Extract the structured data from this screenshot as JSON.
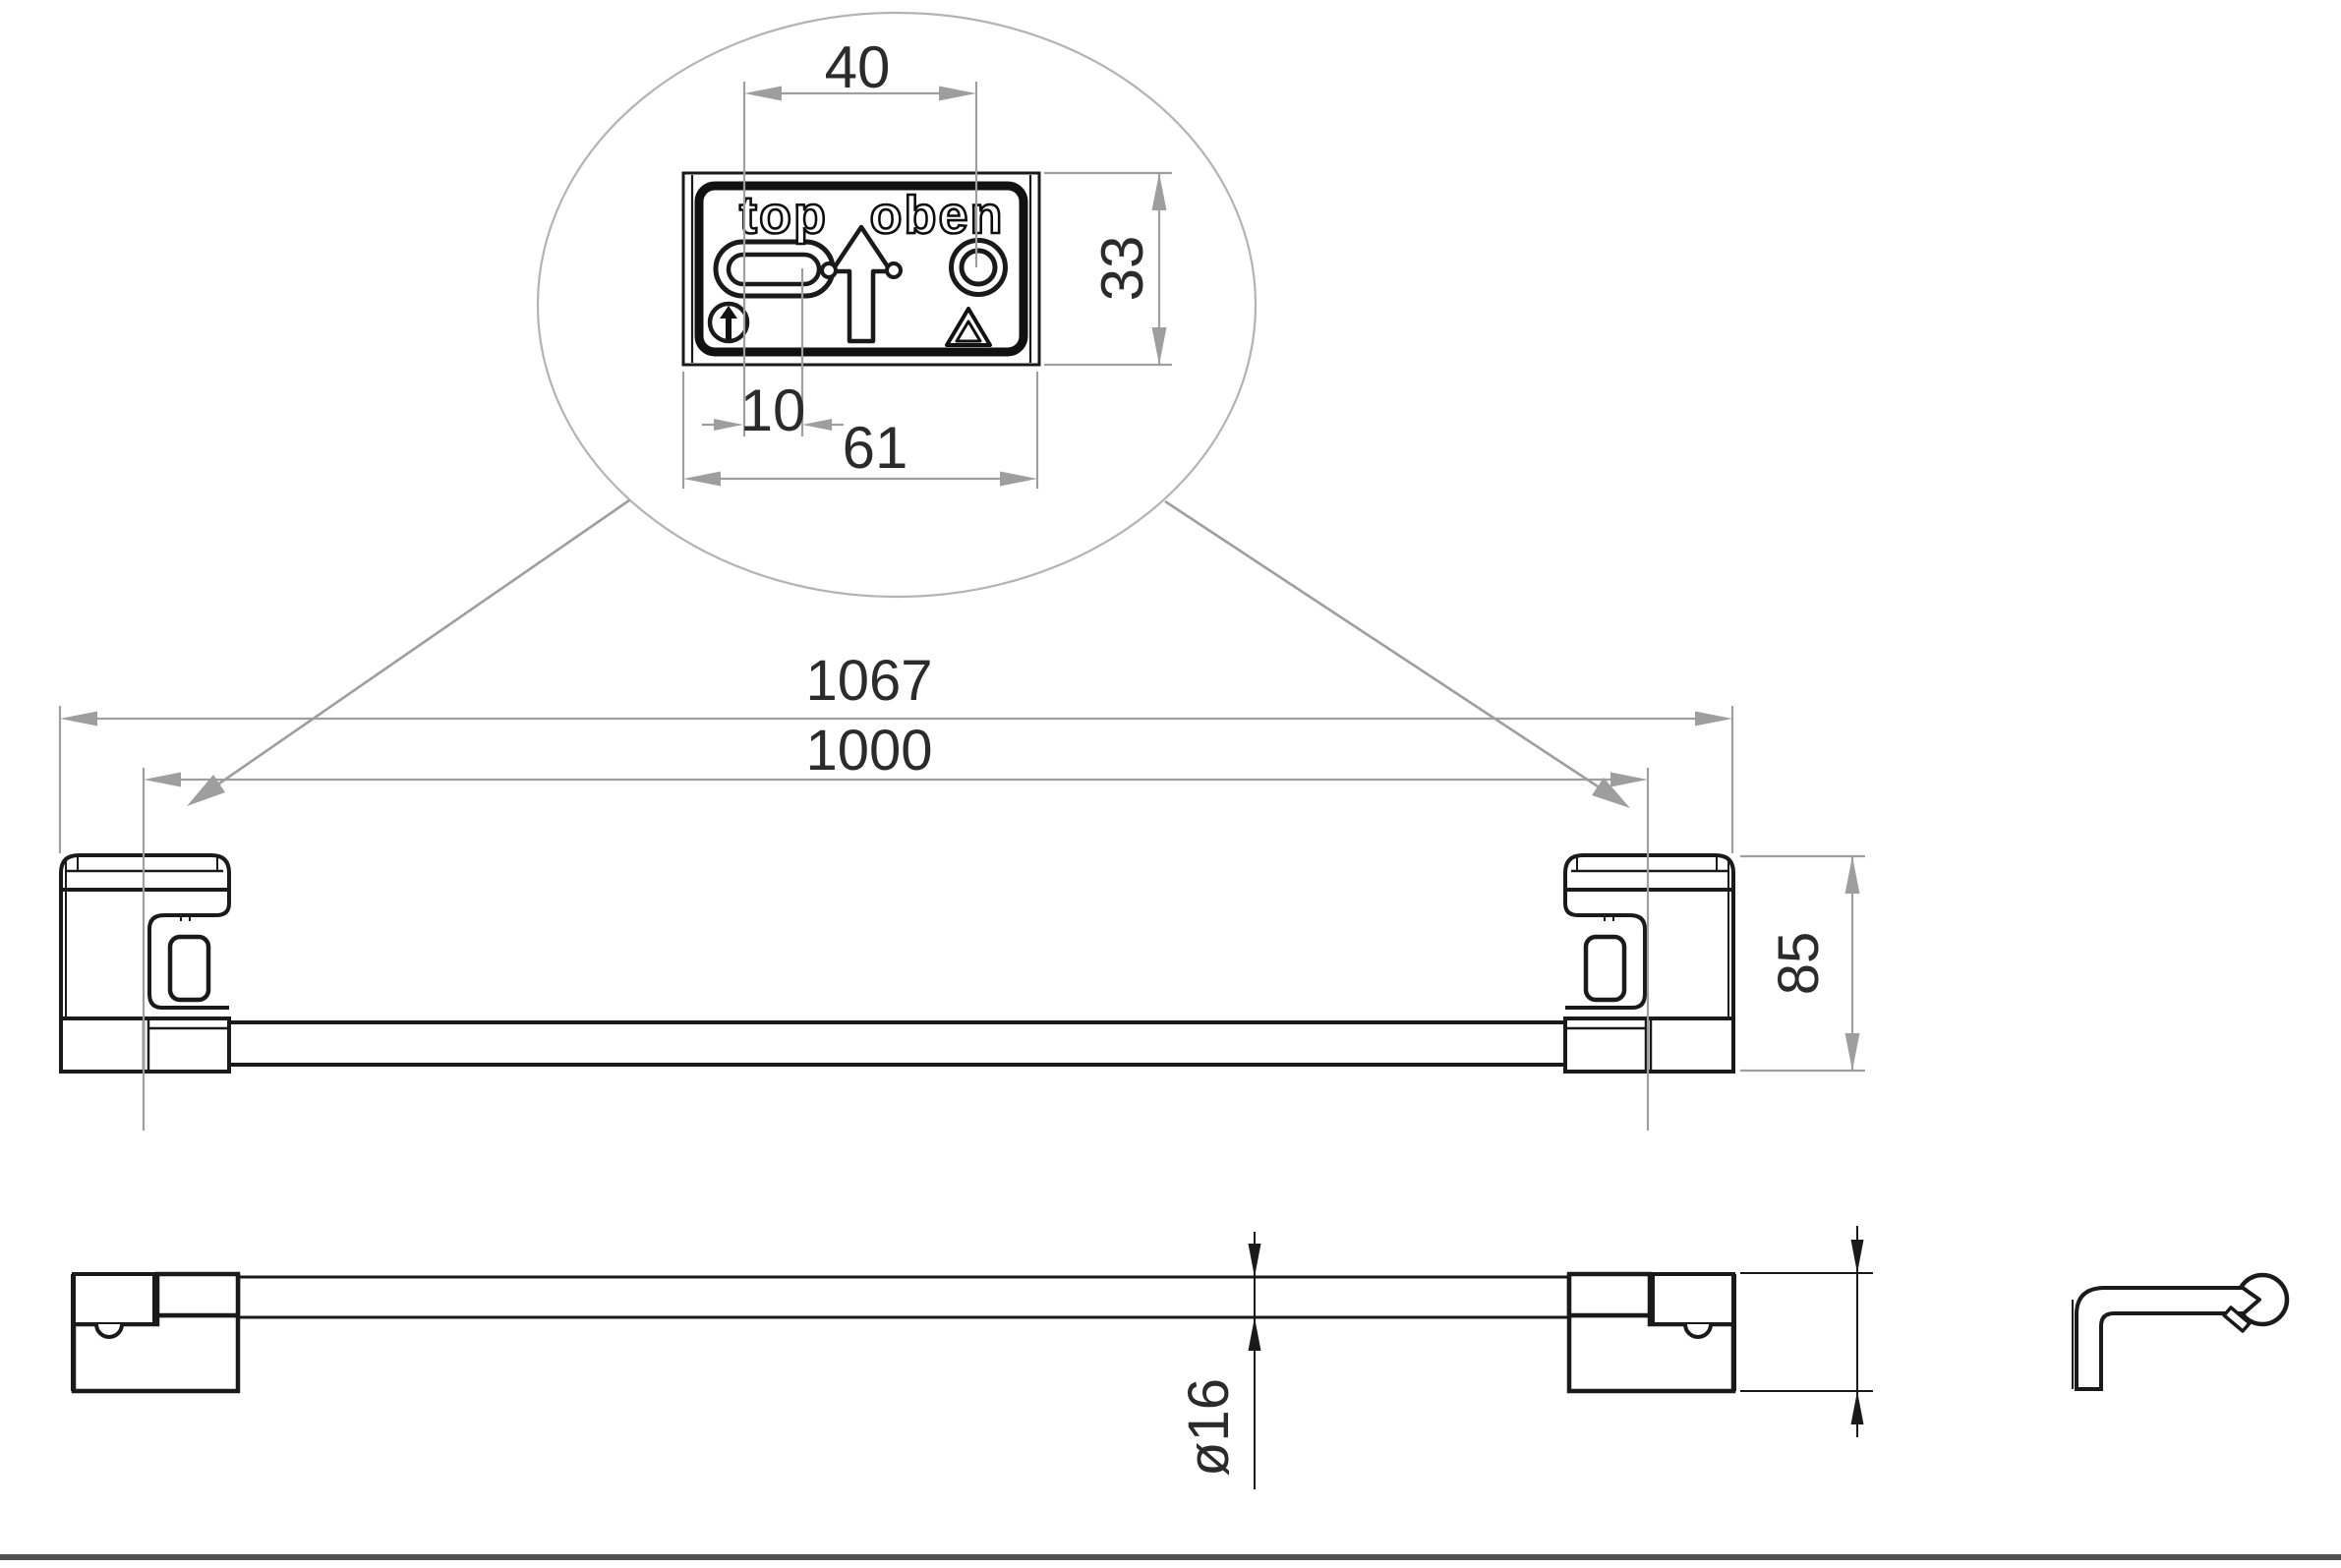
{
  "detail": {
    "plate": {
      "label_left": "top",
      "label_right": "oben"
    },
    "dims": {
      "top_width": "40",
      "height": "33",
      "slot_offset": "10",
      "total_width": "61"
    },
    "icons": {
      "orientation_icon": "circle-up-arrow",
      "recycle_icon": "recycling-triangle",
      "direction_icon": "up-arrow"
    }
  },
  "front": {
    "dims": {
      "overall": "1067",
      "centers": "1000",
      "height": "85"
    }
  },
  "bottom": {
    "dims": {
      "diameter": "ø16"
    }
  },
  "colors": {
    "line": "#1a1a1a",
    "dim_gray": "#9e9e9e",
    "dim_black": "#1a1a1a",
    "text": "#2b2b2b",
    "ellipse": "#b3b3b3",
    "sheet_rule": "#4f4f4f",
    "background": "#ffffff"
  }
}
